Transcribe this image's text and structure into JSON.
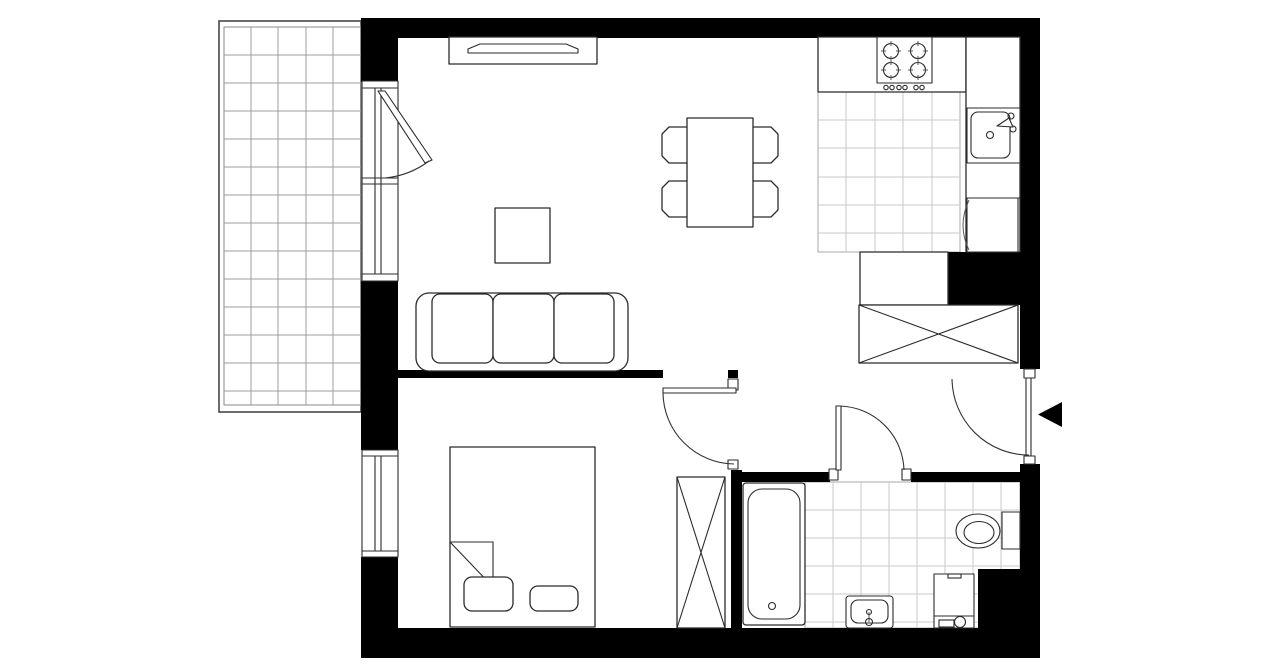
{
  "canvas": {
    "width": 1280,
    "height": 667,
    "background": "#ffffff"
  },
  "palette": {
    "wall": "#000000",
    "line": "#2b2b2b",
    "tile_grid": "#c9c9c9",
    "balcony_grid": "#9e9e9e",
    "paper": "#ffffff"
  },
  "shapes": [
    {
      "t": "rect",
      "n": "balcony-outline-outer",
      "c": "bframe",
      "x": 219,
      "y": 21,
      "w": 142,
      "h": 391
    },
    {
      "t": "rect",
      "n": "balcony-outline-inner",
      "c": "bframe2",
      "x": 224,
      "y": 27,
      "w": 137,
      "h": 378
    },
    {
      "t": "grid",
      "n": "balcony-floor-grid",
      "c": "bgrid",
      "x1": 224,
      "y1": 27,
      "x2": 361,
      "y2": 405,
      "vx": [
        251,
        278,
        306,
        333
      ],
      "hy": [
        55,
        83,
        111,
        139,
        167,
        195,
        223,
        251,
        279,
        307,
        335,
        363,
        391
      ]
    },
    {
      "t": "rect",
      "n": "kitchen-floor-border",
      "c": "tileB",
      "x": 818,
      "y": 92,
      "w": 142,
      "h": 160
    },
    {
      "t": "grid",
      "n": "kitchen-floor-grid",
      "c": "tile",
      "x1": 818,
      "y1": 92,
      "x2": 960,
      "y2": 252,
      "vx": [
        846,
        875,
        903,
        932
      ],
      "hy": [
        120,
        148,
        177,
        205,
        233
      ]
    },
    {
      "t": "rect",
      "n": "bathroom-floor-border",
      "c": "tileB",
      "x": 805,
      "y": 482,
      "w": 215,
      "h": 146
    },
    {
      "t": "grid",
      "n": "bathroom-floor-grid",
      "c": "tile",
      "x1": 805,
      "y1": 482,
      "x2": 1020,
      "y2": 628,
      "vx": [
        833,
        861,
        889,
        917,
        945,
        973,
        1001
      ],
      "hy": [
        510,
        538,
        566,
        594,
        622
      ]
    },
    {
      "t": "rect",
      "n": "wall-top",
      "c": "wall",
      "x": 361,
      "y": 18,
      "w": 679,
      "h": 20
    },
    {
      "t": "rect",
      "n": "wall-left-upper",
      "c": "wall",
      "x": 361,
      "y": 18,
      "w": 37,
      "h": 64
    },
    {
      "t": "rect",
      "n": "wall-left-middle",
      "c": "wall",
      "x": 361,
      "y": 281,
      "w": 37,
      "h": 169
    },
    {
      "t": "rect",
      "n": "wall-left-lower",
      "c": "wall",
      "x": 361,
      "y": 557,
      "w": 37,
      "h": 71
    },
    {
      "t": "rect",
      "n": "wall-bottom",
      "c": "wall",
      "x": 361,
      "y": 628,
      "w": 679,
      "h": 30
    },
    {
      "t": "rect",
      "n": "wall-right-upper",
      "c": "wall",
      "x": 1020,
      "y": 18,
      "w": 20,
      "h": 351
    },
    {
      "t": "rect",
      "n": "wall-right-lower",
      "c": "wall",
      "x": 1020,
      "y": 464,
      "w": 20,
      "h": 164
    },
    {
      "t": "rect",
      "n": "wall-living-bedroom-a",
      "c": "wall",
      "x": 395,
      "y": 370,
      "w": 268,
      "h": 8
    },
    {
      "t": "rect",
      "n": "wall-living-bedroom-b",
      "c": "wall",
      "x": 728,
      "y": 370,
      "w": 10,
      "h": 8
    },
    {
      "t": "rect",
      "n": "wall-bedroom-bathroom",
      "c": "wall",
      "x": 731,
      "y": 470,
      "w": 11,
      "h": 158
    },
    {
      "t": "rect",
      "n": "wall-bathroom-top-left",
      "c": "wall",
      "x": 742,
      "y": 472,
      "w": 88,
      "h": 10
    },
    {
      "t": "rect",
      "n": "wall-bathroom-top-right",
      "c": "wall",
      "x": 911,
      "y": 472,
      "w": 109,
      "h": 10
    },
    {
      "t": "rect",
      "n": "wall-kitchen-block",
      "c": "wall",
      "x": 948,
      "y": 252,
      "w": 72,
      "h": 53
    },
    {
      "t": "rect",
      "n": "wall-bathroom-corner-block",
      "c": "wall",
      "x": 978,
      "y": 569,
      "w": 42,
      "h": 59
    },
    {
      "t": "rect",
      "n": "entry-door-jamb-top",
      "c": "fx2",
      "x": 1024,
      "y": 369,
      "w": 11,
      "h": 9
    },
    {
      "t": "rect",
      "n": "entry-door-jamb-bottom",
      "c": "fx2",
      "x": 1024,
      "y": 456,
      "w": 11,
      "h": 8
    },
    {
      "t": "rect",
      "n": "bedroom-door-jamb-top",
      "c": "fx2",
      "x": 728,
      "y": 379,
      "w": 10,
      "h": 11
    },
    {
      "t": "rect",
      "n": "bedroom-door-jamb-bottom",
      "c": "fx2",
      "x": 728,
      "y": 460,
      "w": 10,
      "h": 9
    },
    {
      "t": "rect",
      "n": "bathroom-door-jamb-left",
      "c": "fx2",
      "x": 829,
      "y": 469,
      "w": 9,
      "h": 11
    },
    {
      "t": "rect",
      "n": "bathroom-door-jamb-right",
      "c": "fx2",
      "x": 902,
      "y": 469,
      "w": 9,
      "h": 11
    },
    {
      "t": "rect",
      "n": "kitchen-counter-top",
      "c": "fx",
      "x": 818,
      "y": 37,
      "w": 148,
      "h": 55
    },
    {
      "t": "rect",
      "n": "kitchen-counter-right",
      "c": "fx",
      "x": 966,
      "y": 37,
      "w": 54,
      "h": 215
    },
    {
      "t": "rect",
      "n": "stove",
      "c": "fx2",
      "x": 877,
      "y": 37,
      "w": 55,
      "h": 46
    },
    {
      "t": "circle",
      "n": "stove-burner-1",
      "c": "ln",
      "cx": 891,
      "cy": 51,
      "r": 7.5
    },
    {
      "t": "circle",
      "n": "stove-burner-2",
      "c": "ln",
      "cx": 918,
      "cy": 51,
      "r": 7.5
    },
    {
      "t": "circle",
      "n": "stove-burner-3",
      "c": "ln",
      "cx": 891,
      "cy": 70,
      "r": 7.5
    },
    {
      "t": "circle",
      "n": "stove-burner-4",
      "c": "ln",
      "cx": 918,
      "cy": 70,
      "r": 7.5
    },
    {
      "t": "path",
      "n": "stove-burner-ticks-1",
      "c": "thin",
      "d": "M891,41 V46 M891,56 V61 M881,51 H886 M896,51 H901"
    },
    {
      "t": "path",
      "n": "stove-burner-ticks-2",
      "c": "thin",
      "d": "M918,41 V46 M918,56 V61 M908,51 H913 M923,51 H928"
    },
    {
      "t": "path",
      "n": "stove-burner-ticks-3",
      "c": "thin",
      "d": "M891,60 V65 M891,75 V80 M881,70 H886 M896,70 H901"
    },
    {
      "t": "path",
      "n": "stove-burner-ticks-4",
      "c": "thin",
      "d": "M918,60 V65 M918,75 V80 M908,70 H913 M923,70 H928"
    },
    {
      "t": "circle",
      "n": "stove-knob-1",
      "c": "ln",
      "cx": 886,
      "cy": 87.5,
      "r": 2.2
    },
    {
      "t": "circle",
      "n": "stove-knob-2",
      "c": "ln",
      "cx": 892,
      "cy": 87.5,
      "r": 2.2
    },
    {
      "t": "circle",
      "n": "stove-knob-3",
      "c": "ln",
      "cx": 899,
      "cy": 87.5,
      "r": 2.2
    },
    {
      "t": "circle",
      "n": "stove-knob-4",
      "c": "ln",
      "cx": 905,
      "cy": 87.5,
      "r": 2.2
    },
    {
      "t": "circle",
      "n": "stove-knob-5",
      "c": "ln",
      "cx": 916,
      "cy": 87.5,
      "r": 2.2
    },
    {
      "t": "circle",
      "n": "stove-knob-6",
      "c": "ln",
      "cx": 922,
      "cy": 87.5,
      "r": 2.2
    },
    {
      "t": "rect",
      "n": "kitchen-sink-unit",
      "c": "fx2",
      "x": 967,
      "y": 108,
      "w": 53,
      "h": 55
    },
    {
      "t": "rect",
      "n": "kitchen-sink-basin",
      "c": "ln",
      "x": 971,
      "y": 112,
      "w": 39,
      "h": 46,
      "rx": 7
    },
    {
      "t": "circle",
      "n": "kitchen-sink-drain",
      "c": "ln",
      "cx": 990,
      "cy": 135,
      "r": 3.5
    },
    {
      "t": "circle",
      "n": "kitchen-faucet-base",
      "c": "ln",
      "cx": 1011,
      "cy": 116,
      "r": 3
    },
    {
      "t": "circle",
      "n": "kitchen-faucet-handle",
      "c": "ln",
      "cx": 1013,
      "cy": 129,
      "r": 3
    },
    {
      "t": "polygon",
      "n": "kitchen-faucet-spout",
      "c": "fx2",
      "pts": "1009,118 1013,127 997,126"
    },
    {
      "t": "line",
      "n": "kitchen-counter-divider",
      "c": "ln",
      "x1": 966,
      "y1": 198,
      "x2": 1020,
      "y2": 198
    },
    {
      "t": "rect",
      "n": "fridge",
      "c": "fx2",
      "x": 967,
      "y": 198,
      "w": 51,
      "h": 54
    },
    {
      "t": "path",
      "n": "fridge-door-swing",
      "c": "thin",
      "d": "M969,200 Q957,226 969,250"
    },
    {
      "t": "rect",
      "n": "hall-cabinet",
      "c": "fx",
      "x": 860,
      "y": 252,
      "w": 88,
      "h": 53
    },
    {
      "t": "rect",
      "n": "hall-wardrobe",
      "c": "fx",
      "x": 859,
      "y": 305,
      "w": 159,
      "h": 58
    },
    {
      "t": "line",
      "n": "hall-wardrobe-cross-1",
      "c": "ln",
      "x1": 859,
      "y1": 305,
      "x2": 1018,
      "y2": 363
    },
    {
      "t": "line",
      "n": "hall-wardrobe-cross-2",
      "c": "ln",
      "x1": 859,
      "y1": 363,
      "x2": 1018,
      "y2": 305
    },
    {
      "t": "rect",
      "n": "tv-cabinet",
      "c": "fx",
      "x": 449,
      "y": 37,
      "w": 148,
      "h": 27
    },
    {
      "t": "polygon",
      "n": "tv",
      "c": "fx2",
      "pts": "468,53 578,53 578,49 566,44 480,44 468,49"
    },
    {
      "t": "polygon",
      "n": "dining-chair-left-top",
      "c": "fx",
      "pts": "688,127 669,127 662,134 662,156 669,163 688,163"
    },
    {
      "t": "polygon",
      "n": "dining-chair-left-bottom",
      "c": "fx",
      "pts": "688,181 669,181 662,188 662,210 669,217 688,217"
    },
    {
      "t": "polygon",
      "n": "dining-chair-right-top",
      "c": "fx",
      "pts": "752,127 771,127 778,134 778,156 771,163 752,163"
    },
    {
      "t": "polygon",
      "n": "dining-chair-right-bottom",
      "c": "fx",
      "pts": "752,181 771,181 778,188 778,210 771,217 752,217"
    },
    {
      "t": "rect",
      "n": "dining-table",
      "c": "fx",
      "x": 687,
      "y": 118,
      "w": 66,
      "h": 109
    },
    {
      "t": "rect",
      "n": "coffee-table",
      "c": "fx",
      "x": 495,
      "y": 208,
      "w": 55,
      "h": 55
    },
    {
      "t": "rect",
      "n": "sofa-body",
      "c": "fx",
      "x": 416,
      "y": 293,
      "w": 212,
      "h": 78,
      "rx": 13
    },
    {
      "t": "rect",
      "n": "sofa-cushion-1",
      "c": "fx",
      "x": 432,
      "y": 294,
      "w": 61,
      "h": 69,
      "rx": 8
    },
    {
      "t": "rect",
      "n": "sofa-cushion-2",
      "c": "fx",
      "x": 493,
      "y": 294,
      "w": 61,
      "h": 69,
      "rx": 8
    },
    {
      "t": "rect",
      "n": "sofa-cushion-3",
      "c": "fx",
      "x": 554,
      "y": 294,
      "w": 60,
      "h": 69,
      "rx": 8
    },
    {
      "t": "rect",
      "n": "bed",
      "c": "fx",
      "x": 450,
      "y": 447,
      "w": 145,
      "h": 180
    },
    {
      "t": "path",
      "n": "bed-blanket-fold",
      "c": "ln",
      "d": "M450,542 H493 V587 M450,542 L493,587"
    },
    {
      "t": "rect",
      "n": "bed-pillow-1",
      "c": "fx",
      "x": 464,
      "y": 577,
      "w": 49,
      "h": 34,
      "rx": 8
    },
    {
      "t": "rect",
      "n": "bed-pillow-2",
      "c": "fx",
      "x": 530,
      "y": 586,
      "w": 48,
      "h": 25,
      "rx": 8
    },
    {
      "t": "rect",
      "n": "bedroom-wardrobe",
      "c": "fx",
      "x": 677,
      "y": 477,
      "w": 48,
      "h": 151
    },
    {
      "t": "line",
      "n": "bedroom-wardrobe-cross-1",
      "c": "ln",
      "x1": 677,
      "y1": 477,
      "x2": 725,
      "y2": 628
    },
    {
      "t": "line",
      "n": "bedroom-wardrobe-cross-2",
      "c": "ln",
      "x1": 677,
      "y1": 628,
      "x2": 725,
      "y2": 477
    },
    {
      "t": "rect",
      "n": "bathtub-outer",
      "c": "fx",
      "x": 743,
      "y": 483,
      "w": 62,
      "h": 142,
      "rx": 3
    },
    {
      "t": "rect",
      "n": "bathtub-inner",
      "c": "ln",
      "x": 748,
      "y": 489,
      "w": 52,
      "h": 130,
      "rx": 14
    },
    {
      "t": "circle",
      "n": "bathtub-drain",
      "c": "ln",
      "cx": 772,
      "cy": 606,
      "r": 3.5
    },
    {
      "t": "rect",
      "n": "toilet-tank",
      "c": "fx2",
      "x": 1002,
      "y": 512,
      "w": 18,
      "h": 37
    },
    {
      "t": "ellipse",
      "n": "toilet-bowl",
      "c": "fx2",
      "cx": 978,
      "cy": 531,
      "rx": 22,
      "ry": 17
    },
    {
      "t": "ellipse",
      "n": "toilet-bowl-inner",
      "c": "ln",
      "cx": 979,
      "cy": 532.5,
      "rx": 15,
      "ry": 11
    },
    {
      "t": "rect",
      "n": "washbasin",
      "c": "fx2",
      "x": 846,
      "y": 596,
      "w": 47,
      "h": 32,
      "rx": 3
    },
    {
      "t": "rect",
      "n": "washbasin-inner",
      "c": "ln",
      "x": 851,
      "y": 600,
      "w": 37,
      "h": 23,
      "rx": 7
    },
    {
      "t": "line",
      "n": "washbasin-faucet-stem",
      "c": "thin",
      "x1": 869,
      "y1": 612,
      "x2": 869,
      "y2": 622
    },
    {
      "t": "circle",
      "n": "washbasin-faucet-top",
      "c": "ln",
      "cx": 869,
      "cy": 612,
      "r": 2.5
    },
    {
      "t": "circle",
      "n": "washbasin-faucet-base",
      "c": "ln",
      "cx": 869,
      "cy": 622,
      "r": 3.5
    },
    {
      "t": "rect",
      "n": "washing-machine",
      "c": "fx2",
      "x": 934,
      "y": 574,
      "w": 40,
      "h": 54
    },
    {
      "t": "rect",
      "n": "washing-machine-notch",
      "c": "ln",
      "x": 948,
      "y": 574,
      "w": 13,
      "h": 4
    },
    {
      "t": "line",
      "n": "washing-machine-panel-divider",
      "c": "ln",
      "x1": 934,
      "y1": 616,
      "x2": 974,
      "y2": 616
    },
    {
      "t": "rect",
      "n": "washing-machine-drawer",
      "c": "ln",
      "x": 939,
      "y": 620,
      "w": 15,
      "h": 7
    },
    {
      "t": "circle",
      "n": "washing-machine-door",
      "c": "ln",
      "cx": 960,
      "cy": 622,
      "r": 5.5
    },
    {
      "t": "rect",
      "n": "living-window-frame",
      "c": "fx2",
      "x": 362,
      "y": 81,
      "w": 36,
      "h": 200
    },
    {
      "t": "line",
      "n": "living-window-glazing-1",
      "c": "ln",
      "x1": 375,
      "y1": 88,
      "x2": 375,
      "y2": 274
    },
    {
      "t": "line",
      "n": "living-window-glazing-2",
      "c": "ln",
      "x1": 381,
      "y1": 88,
      "x2": 381,
      "y2": 274
    },
    {
      "t": "line",
      "n": "living-window-head",
      "c": "ln",
      "x1": 362,
      "y1": 88,
      "x2": 398,
      "y2": 88
    },
    {
      "t": "line",
      "n": "living-window-transom-1",
      "c": "ln",
      "x1": 362,
      "y1": 178,
      "x2": 398,
      "y2": 178
    },
    {
      "t": "line",
      "n": "living-window-transom-2",
      "c": "ln",
      "x1": 362,
      "y1": 184,
      "x2": 398,
      "y2": 184
    },
    {
      "t": "line",
      "n": "living-window-sill",
      "c": "ln",
      "x1": 362,
      "y1": 274,
      "x2": 398,
      "y2": 274
    },
    {
      "t": "rect",
      "n": "bedroom-window-frame",
      "c": "fx2",
      "x": 362,
      "y": 450,
      "w": 36,
      "h": 107
    },
    {
      "t": "line",
      "n": "bedroom-window-glazing-1",
      "c": "ln",
      "x1": 375,
      "y1": 456,
      "x2": 375,
      "y2": 551
    },
    {
      "t": "line",
      "n": "bedroom-window-glazing-2",
      "c": "ln",
      "x1": 381,
      "y1": 456,
      "x2": 381,
      "y2": 551
    },
    {
      "t": "line",
      "n": "bedroom-window-head",
      "c": "ln",
      "x1": 362,
      "y1": 456,
      "x2": 398,
      "y2": 456
    },
    {
      "t": "line",
      "n": "bedroom-window-sill",
      "c": "ln",
      "x1": 362,
      "y1": 551,
      "x2": 398,
      "y2": 551
    },
    {
      "t": "polygon",
      "n": "balcony-door-leaf",
      "c": "fx2",
      "pts": "378,91 385,91 432,160 425,163"
    },
    {
      "t": "path",
      "n": "balcony-door-swing",
      "c": "arc",
      "d": "M429,161 A87,87 0 0 1 385,178"
    },
    {
      "t": "rect",
      "n": "bedroom-door-leaf",
      "c": "fx2",
      "x": 663,
      "y": 388,
      "w": 73,
      "h": 5
    },
    {
      "t": "path",
      "n": "bedroom-door-swing",
      "c": "arc",
      "d": "M663,393 A72,72 0 0 0 734,464"
    },
    {
      "t": "rect",
      "n": "bathroom-door-leaf",
      "c": "fx2",
      "x": 836,
      "y": 406,
      "w": 5,
      "h": 64
    },
    {
      "t": "path",
      "n": "bathroom-door-swing",
      "c": "arc",
      "d": "M840,406 A66,66 0 0 1 904,470"
    },
    {
      "t": "rect",
      "n": "entry-door-leaf",
      "c": "fx2",
      "x": 1026,
      "y": 378,
      "w": 5,
      "h": 78
    },
    {
      "t": "path",
      "n": "entry-door-swing",
      "c": "arc",
      "d": "M952,379 A77,77 0 0 0 1029,455"
    },
    {
      "t": "polygon",
      "n": "entry-arrow",
      "c": "black",
      "pts": "1062,402 1062,427 1038,414.5"
    }
  ]
}
